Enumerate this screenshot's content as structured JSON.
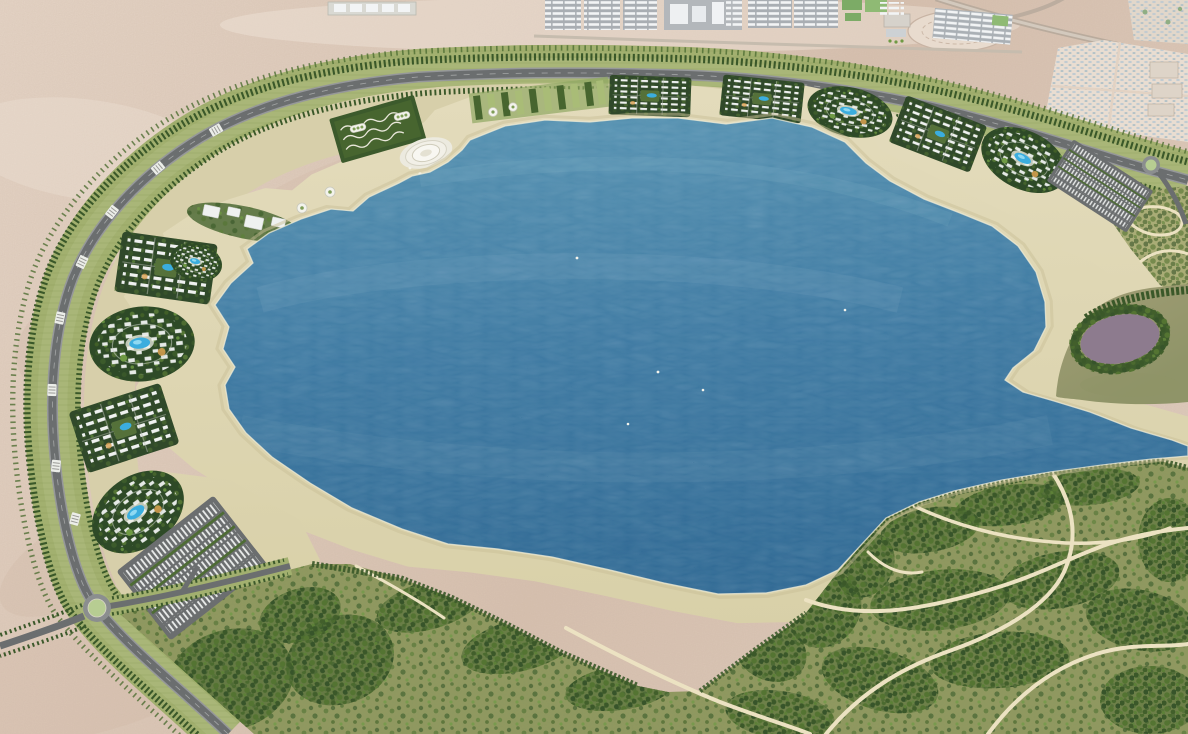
{
  "scene": {
    "type": "aerial-masterplan-rendering",
    "setting": "circular lagoon resort masterplan surrounded by desert",
    "regions": {
      "lagoon": "large irregular blue lagoon filling the center",
      "beach": "cream sand ring surrounding the lagoon",
      "ring_boulevard": "tree-lined circular boulevard enclosing the development",
      "resort_band": "resort villages with swimming pools between road and beach",
      "desert": "pink-tan desert outside the ring",
      "industrial_district": "rows of warehouse blocks along the top edge",
      "housing_grid": "gridded plot settlement in the top-right desert",
      "utility_compound": "oval fenced compound in the north desert",
      "lakeside_park": "landscaped park with tree clusters and winding paths at bottom right",
      "east_peninsula": "tree-ringed mauve pond on the eastern shore",
      "circular_plaza": "white circular amphitheater plaza on the north beach promontory",
      "terraced_gardens": "cascading garden terraces behind the plaza",
      "parking_lots": "white striped parking banks near both roundabouts",
      "roundabouts": "southwest and northeast roundabouts on the ring road",
      "boats": "tiny white boats on the lagoon"
    },
    "counts": {
      "resort_clusters": 11,
      "roundabouts": 2,
      "parking_lots": 2,
      "boats": 5,
      "fountain_plazas": 9
    }
  },
  "colors": {
    "desert_1": "#e7d7c9",
    "desert_2": "#d8c2b1",
    "desert_shadow": "#c3a794",
    "desert_road": "#b9ab9d",
    "water_light": "#5f9ab8",
    "water_mid": "#3f7aa4",
    "water_deep": "#2b6390",
    "beach_1": "#e4dcbd",
    "beach_2": "#d7cfa6",
    "sand_apron": "#d7cfaa",
    "beach_wet": "#c9bf98",
    "park_grass": "#949a60",
    "park_light": "#a9ac76",
    "peninsula": "#a19d75",
    "tree_dark": "#3a5829",
    "tree_mid": "#4f6e33",
    "tree_light": "#6f9c42",
    "ring_band": "#a2b06f",
    "ring_band_light": "#aeba7e",
    "road": "#6b6e6f",
    "road_light": "#96989a",
    "pond": "#8d7b8e",
    "pool": "#3badde",
    "pool_light": "#8fd9f2",
    "building_white": "#eff1f0",
    "industrial_pad": "#a9aeb3",
    "industrial_green": "#7cab66",
    "housing_dot": "#bcc9d1",
    "path_cream": "#ece2c2",
    "roundabout_green": "#b7cd92",
    "foam": "#f1eed8"
  }
}
